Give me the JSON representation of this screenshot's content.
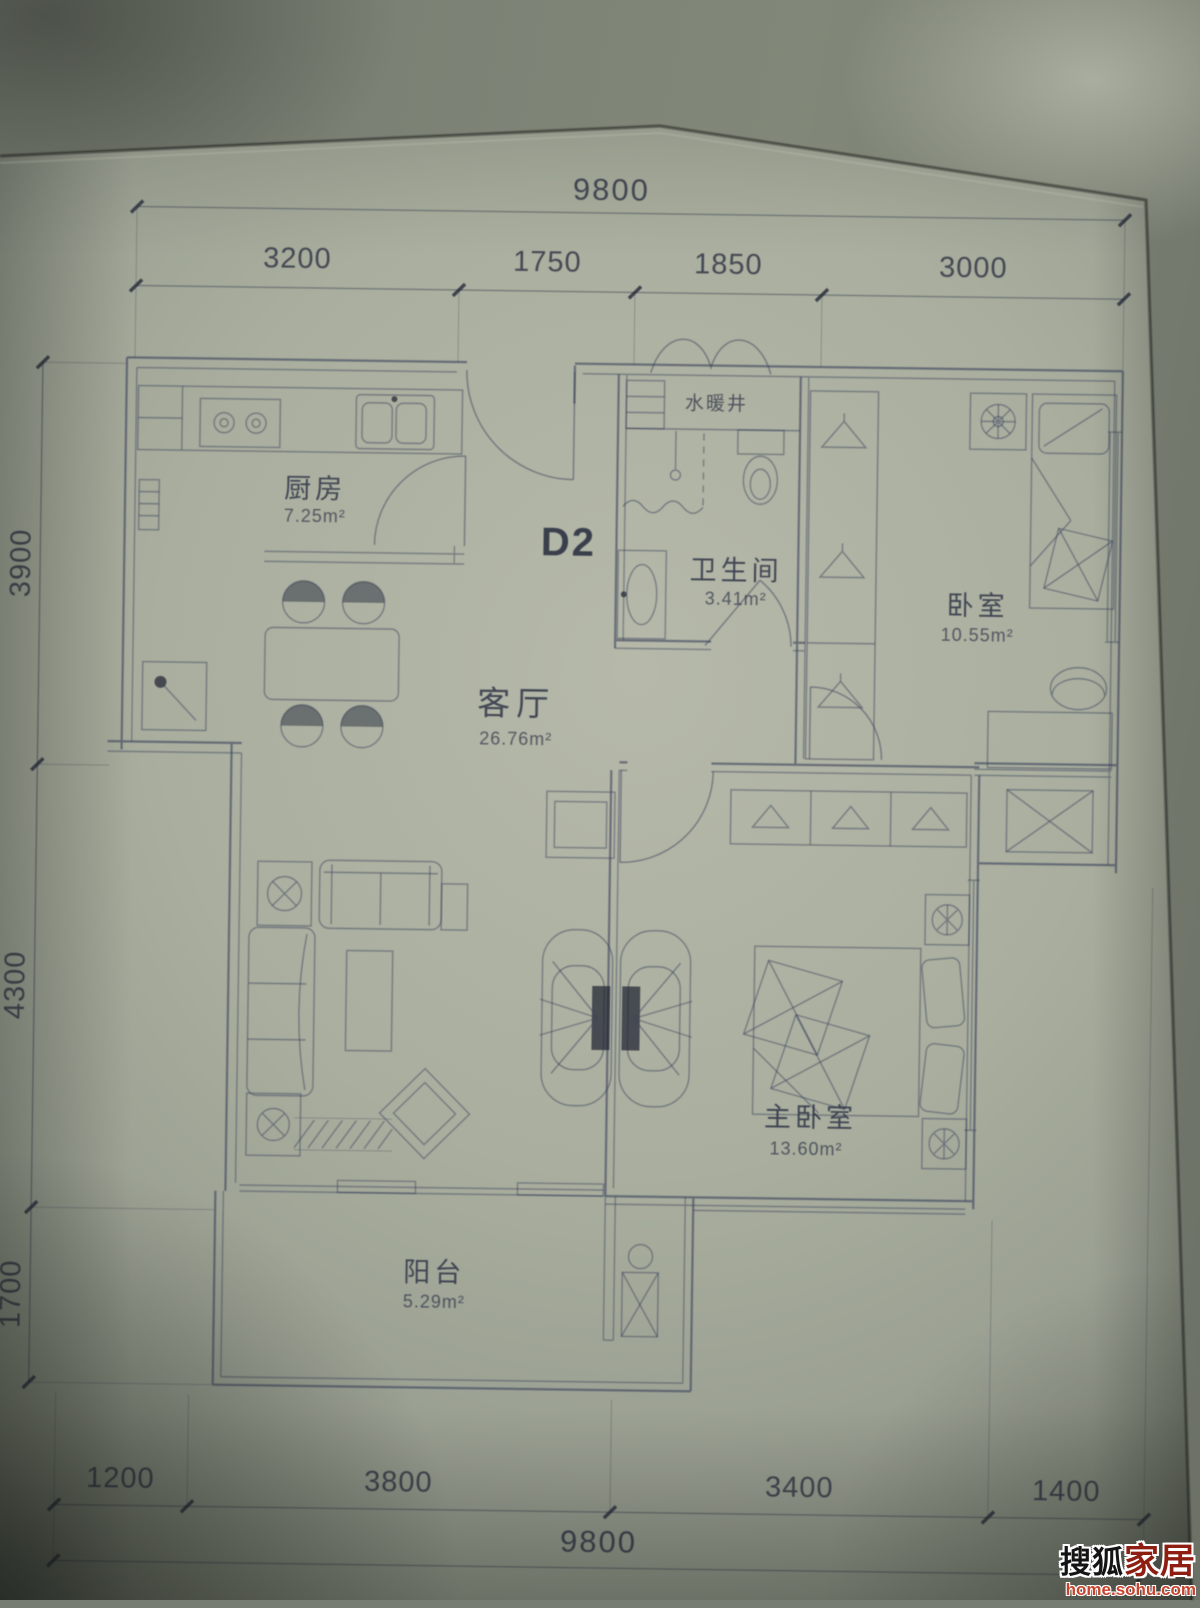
{
  "plan": {
    "unit_label": "D2",
    "shaft_label": "水暖井",
    "rooms": {
      "kitchen": {
        "name": "厨房",
        "area": "7.25m²"
      },
      "bathroom": {
        "name": "卫生间",
        "area": "3.41m²"
      },
      "bedroom": {
        "name": "卧室",
        "area": "10.55m²"
      },
      "living": {
        "name": "客厅",
        "area": "26.76m²"
      },
      "master": {
        "name": "主卧室",
        "area": "13.60m²"
      },
      "balcony": {
        "name": "阳台",
        "area": "5.29m²"
      }
    },
    "dims": {
      "top_total": "9800",
      "top": [
        "3200",
        "1750",
        "1850",
        "3000"
      ],
      "left": [
        "3900",
        "4300",
        "1700"
      ],
      "bottom": [
        "1200",
        "3800",
        "3400",
        "1400"
      ],
      "bottom_total": "9800"
    }
  },
  "watermark": {
    "brand_black": "搜狐",
    "brand_red": "家居",
    "site": "home.sohu.com"
  }
}
